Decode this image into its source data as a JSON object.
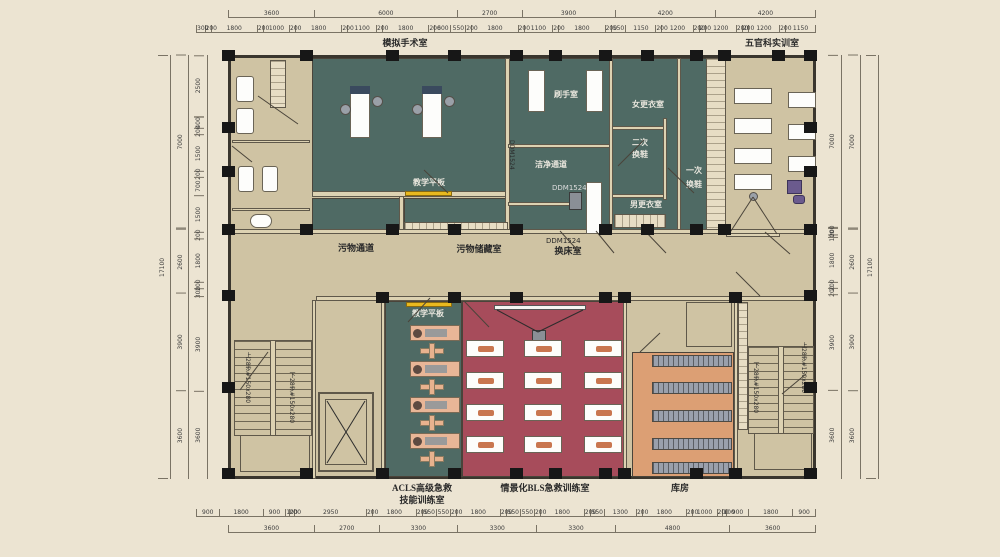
{
  "labels": {
    "or_room": "模拟手术室",
    "ent_room": "五官科实训室",
    "scrub": "刷手室",
    "clean_corridor": "洁净通道",
    "women_change": "女更衣室",
    "second_shoe_1": "二次",
    "second_shoe_2": "换鞋",
    "first_shoe_1": "一次",
    "first_shoe_2": "换鞋",
    "men_change": "男更衣室",
    "teach_board_top": "教学平板",
    "teach_board_bottom": "教学平板",
    "dirty_corridor": "污物通道",
    "dirty_storage": "污物储藏室",
    "bed_change": "换床室",
    "acls_line1": "ACLS高级急救",
    "acls_line2": "技能训练室",
    "bls_room": "情景化BLS急救训练室",
    "storage": "库房",
    "door_mark": "DDM1524",
    "stair_up": "上28步#150x280",
    "stair_down": "下28步#150x280"
  },
  "colors": {
    "teal_room": "#4f6a64",
    "red_room": "#a74c5b",
    "floor_tan": "#cfc3a3",
    "storage_orange": "#dc9f74",
    "teach_board_yellow": "#e9b91f",
    "background": "#ece4d2"
  },
  "dims": {
    "top_segments": [
      "3600",
      "6000",
      "2700",
      "3900",
      "4200",
      "4200"
    ],
    "top_detail": [
      "300",
      "200",
      "1800",
      "200",
      "1000",
      "200",
      "1800",
      "200",
      "1100",
      "200",
      "1800",
      "200",
      "600",
      "550",
      "200",
      "1800",
      "200",
      "1100",
      "200",
      "1800",
      "200",
      "550",
      "1150",
      "200",
      "1200",
      "200",
      "200",
      "1200",
      "200",
      "200",
      "1200",
      "200",
      "1150"
    ],
    "bottom_detail": [
      "900",
      "1800",
      "900",
      "100",
      "200",
      "2950",
      "200",
      "1800",
      "200",
      "550",
      "550",
      "200",
      "1800",
      "200",
      "550",
      "550",
      "200",
      "1800",
      "200",
      "550",
      "1300",
      "200",
      "1800",
      "200",
      "1000",
      "200",
      "100",
      "900",
      "1800",
      "900"
    ],
    "bottom_segments": [
      "3600",
      "2700",
      "3300",
      "3300",
      "3300",
      "4800",
      "3600"
    ],
    "left_outer": [
      "17100"
    ],
    "left_mid": [
      "7000",
      "2600",
      "3900",
      "3600"
    ],
    "left_inner": [
      "2500",
      "400",
      "200",
      "1500",
      "200",
      "700",
      "1500",
      "200",
      "1800",
      "200",
      "300",
      "3900",
      "3600"
    ],
    "right_inner": [
      "7000",
      "200",
      "100",
      "1800",
      "200",
      "200",
      "3900",
      "3600"
    ],
    "right_mid": [
      "7000",
      "2600",
      "3900",
      "3600"
    ],
    "right_outer": [
      "17100"
    ]
  }
}
